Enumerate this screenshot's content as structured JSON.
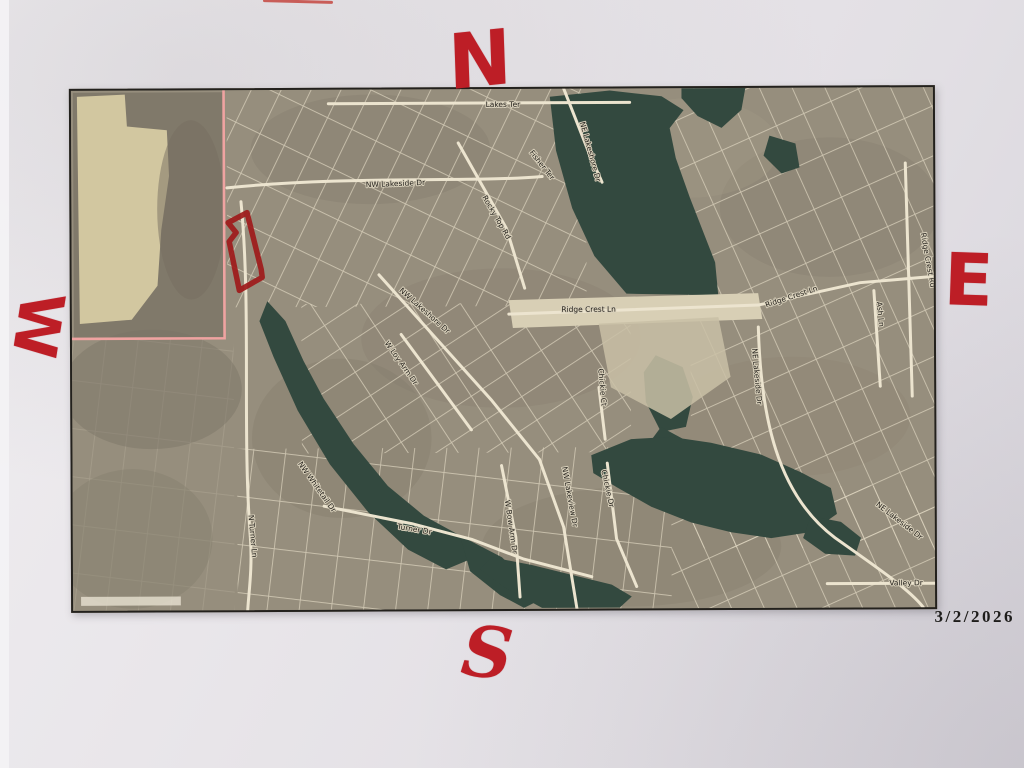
{
  "photo": {
    "description": "Photographed printout of an aerial parcel map with hand-drawn red compass letters and a red-outlined subject parcel",
    "date_stamp": "3/2/2026"
  },
  "compass": {
    "north": "N",
    "south": "S",
    "east": "E",
    "west": "W"
  },
  "map": {
    "marker_color": "#bd1e26",
    "parcel_outline_color": "#9e1a1a",
    "boundary_line_color": "#efa3a1",
    "water_color": "#33493f",
    "field_color": "#d2c7a0",
    "labels": [
      {
        "text": "Lakes Ter"
      },
      {
        "text": "NW Lakeside Dr"
      },
      {
        "text": "Rocky Top Rd"
      },
      {
        "text": "NE Lakeshore Dr"
      },
      {
        "text": "Fisher Ter"
      },
      {
        "text": "Ridge Crest Ln"
      },
      {
        "text": "Ridge Crest Ln"
      },
      {
        "text": "Ridge Crest Rd"
      },
      {
        "text": "Ash Ln"
      },
      {
        "text": "NW Lakeshore Dr"
      },
      {
        "text": "W Loy Arm Dr"
      },
      {
        "text": "N Turner Ln"
      },
      {
        "text": "NW Whitetail Dr"
      },
      {
        "text": "Turner Dr"
      },
      {
        "text": "W Bow Arm Dr"
      },
      {
        "text": "NW Lakeview Dr"
      },
      {
        "text": "Chickie Dr"
      },
      {
        "text": "Chickie Ct"
      },
      {
        "text": "NE Lakeside Dr"
      },
      {
        "text": "NE Lakeside Dr"
      },
      {
        "text": "Valley Dr"
      }
    ]
  }
}
